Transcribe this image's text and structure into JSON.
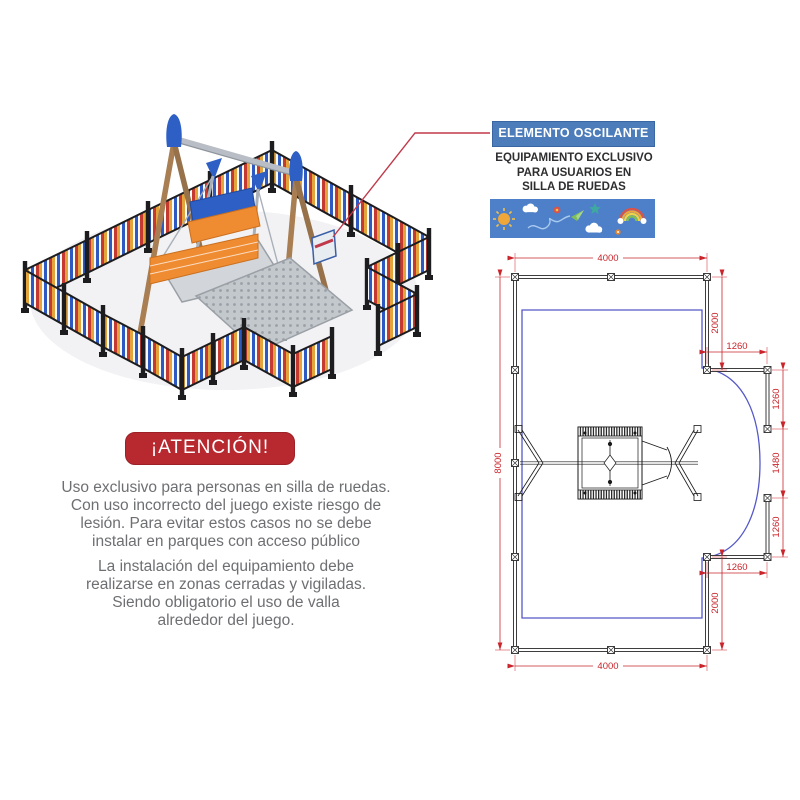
{
  "callout": {
    "title": "ELEMENTO OSCILANTE",
    "subtitle_lines": [
      "EQUIPAMIENTO EXCLUSIVO",
      "PARA USUARIOS EN",
      "SILLA DE RUEDAS"
    ],
    "banner_blue": "#4d7cba",
    "strip_blue": "#4d80c8",
    "doodle_icons": [
      "sun-icon",
      "cloud-icon",
      "flower-icon",
      "scribble-icon",
      "paper-plane-icon",
      "star-icon",
      "cloud-icon",
      "rainbow-icon",
      "flower-icon"
    ]
  },
  "attention": {
    "title": "¡ATENCIÓN!",
    "ribbon_red": "#b7282f",
    "p1_lines": [
      "Uso exclusivo para personas en silla de ruedas.",
      "Con uso incorrecto del juego existe riesgo de",
      "lesión. Para evitar estos casos no se debe",
      "instalar en parques con acceso público"
    ],
    "p2_lines": [
      "La instalación del equipamiento debe",
      "realizarse en zonas cerradas y vigiladas.",
      "Siendo obligatorio el uso de valla",
      "alrededor del juego."
    ]
  },
  "plan": {
    "dim_color": "#c9252b",
    "safety_zone_color": "#5558c8",
    "dims": {
      "top": "4000",
      "bottom": "4000",
      "left": "8000",
      "right_upper": "2000",
      "right_lower": "2000",
      "chicane_top": "1260",
      "chicane_bottom": "1260",
      "gate_upper": "1260",
      "gate_middle": "1480",
      "gate_lower": "1260"
    }
  },
  "illustration": {
    "fence_yellow": "#e2a43b",
    "fence_blue": "#2d59c0",
    "fence_red": "#c43a31",
    "post_black": "#1d1d1f",
    "wood_brown": "#a87e52",
    "metal_gray": "#b9bec6",
    "seat_orange": "#ef8b31",
    "cap_blue": "#2d5fc4",
    "callout_line_red": "#c0394a"
  }
}
